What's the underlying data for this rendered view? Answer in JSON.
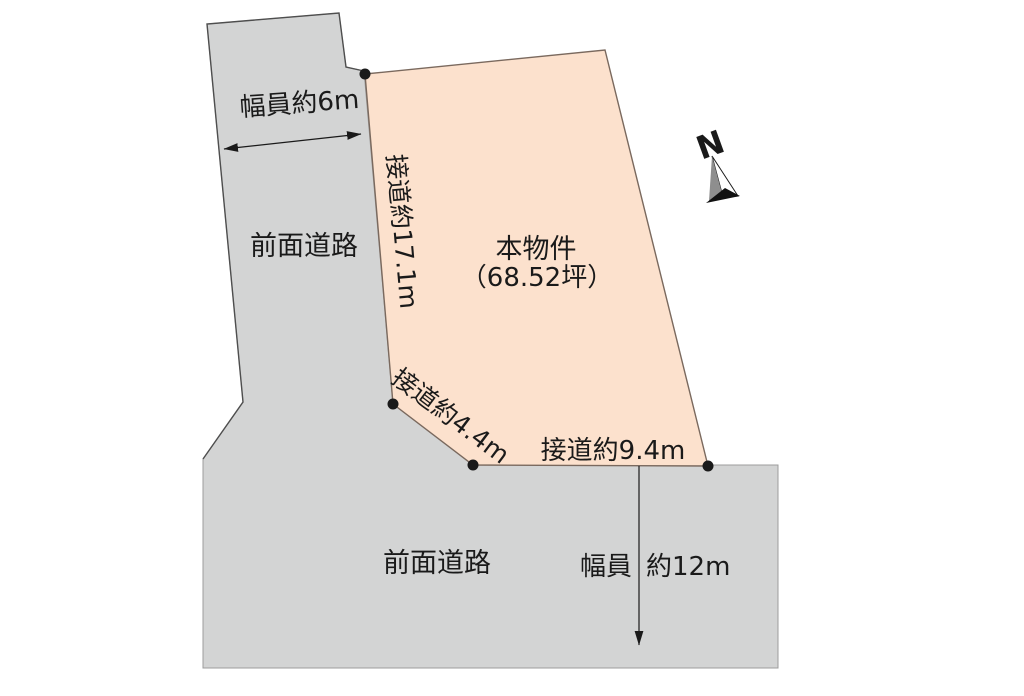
{
  "colors": {
    "background": "#ffffff",
    "road_fill": "#d3d4d4",
    "road_stroke": "#9c9c9c",
    "road_outline": "#4e4e4e",
    "parcel_fill": "#fce1cd",
    "parcel_stroke": "#7a695e",
    "ink": "#1a1a1a",
    "needle_dark": "#8e8e8e",
    "needle_light": "#ffffff",
    "needle_base": "#111111"
  },
  "north": {
    "label": "N"
  },
  "roads": {
    "left": {
      "name": "前面道路",
      "width": "幅員約6m"
    },
    "bottom": {
      "name": "前面道路",
      "width_label": "幅員",
      "width_value": "約12m"
    }
  },
  "parcel": {
    "name": "本物件",
    "area": "（68.52坪）",
    "frontage_west": "接道約17.1m",
    "frontage_southwest": "接道約4.4m",
    "frontage_south": "接道約9.4m"
  }
}
